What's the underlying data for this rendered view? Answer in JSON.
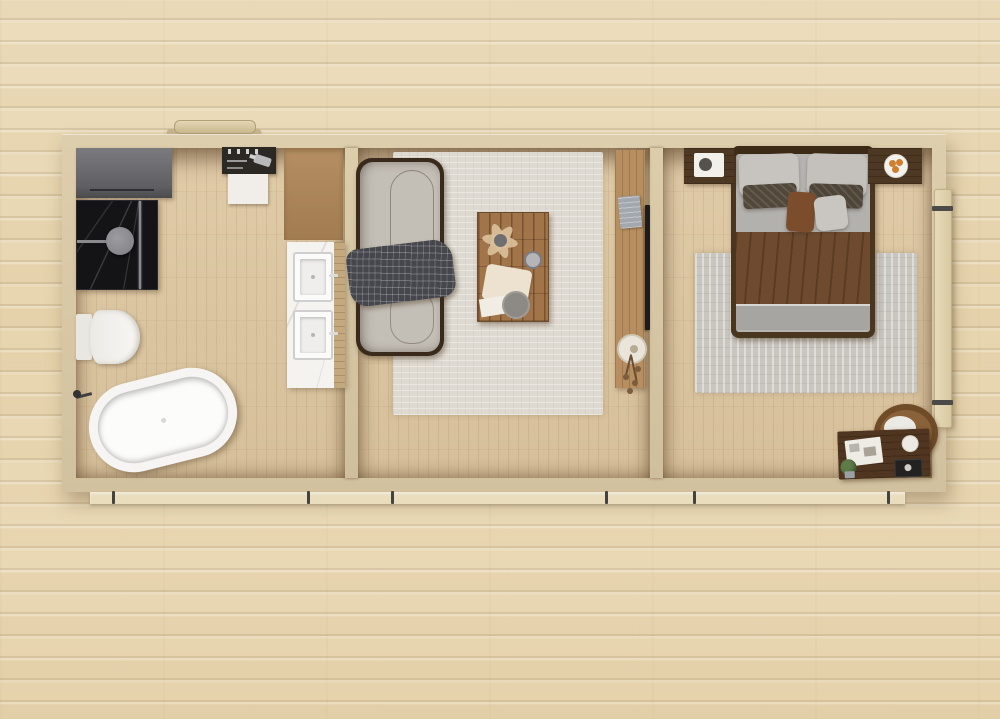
{
  "scene": {
    "title": "Top-down 3D rendered floor plan of a three-room cabin standing on a light wooden plank deck",
    "background": {
      "deck_plank_color": "#e8d6b2",
      "deck_gap_shadow": "#8a6e46",
      "deck_gap_highlight": "#f2ead4"
    },
    "structure": {
      "wall_color": "#d8c8a6",
      "floor_color": "#dbc5a1",
      "skid_color": "#e9ddbe",
      "bracket_color": "#43423f",
      "interior_shadow": "rgba(75,48,22,0.55)"
    },
    "exterior": {
      "items": [
        "top-door-handle",
        "side-door-leaf",
        "foundation-skid",
        "skid-brackets"
      ],
      "door_leaf_color": "#ddd0ad",
      "handle_color": "#d9caa8"
    },
    "rooms": [
      {
        "name": "bathroom",
        "furniture": [
          "wardrobe-cabinet",
          "walk-in-shower",
          "shower-head",
          "wall-shelf-with-toiletries",
          "hair-dryer",
          "towel",
          "tan-counter",
          "marble-vanity",
          "double-sinks",
          "toilet",
          "freestanding-bathtub",
          "bath-faucet"
        ],
        "key_colors": {
          "shower_marble": "#141417",
          "cabinet": "#5f5e62",
          "vanity_marble": "#f5f3ef",
          "tub": "#f6f5f3",
          "counter": "#b58f63"
        }
      },
      {
        "name": "living-room",
        "furniture": [
          "sofa",
          "plaid-throw-blanket",
          "area-rug",
          "rustic-coffee-table",
          "dried-flower-arrangement",
          "mug",
          "cloth",
          "serving-plate",
          "media-console",
          "speaker",
          "round-vase-with-dried-flowers",
          "wall-mounted-tv"
        ],
        "key_colors": {
          "sofa_cushion": "#c3beb6",
          "sofa_frame": "#3a2a1b",
          "rug": "#dfdad1",
          "table": "#a1744a",
          "console": "#b68e60",
          "throw": "#46474d"
        }
      },
      {
        "name": "bedroom",
        "furniture": [
          "double-bed",
          "headboard",
          "gray-pillows",
          "dark-accent-pillows",
          "brown-lumbar-pillow",
          "brown-throw-blanket",
          "folded-sheet",
          "nightstand-left-with-tray",
          "nightstand-right-with-fruit-plate",
          "area-rug",
          "writing-desk",
          "hoop-back-chair",
          "desk-papers",
          "potted-plant",
          "photo-print",
          "cup-with-flower"
        ],
        "key_colors": {
          "duvet": "#b3b1ae",
          "blanket": "#6e4b2f",
          "bed_frame": "#4a351f",
          "rug": "#c9c6c0",
          "desk": "#503620",
          "fruit": "#d07f2e"
        }
      }
    ]
  }
}
